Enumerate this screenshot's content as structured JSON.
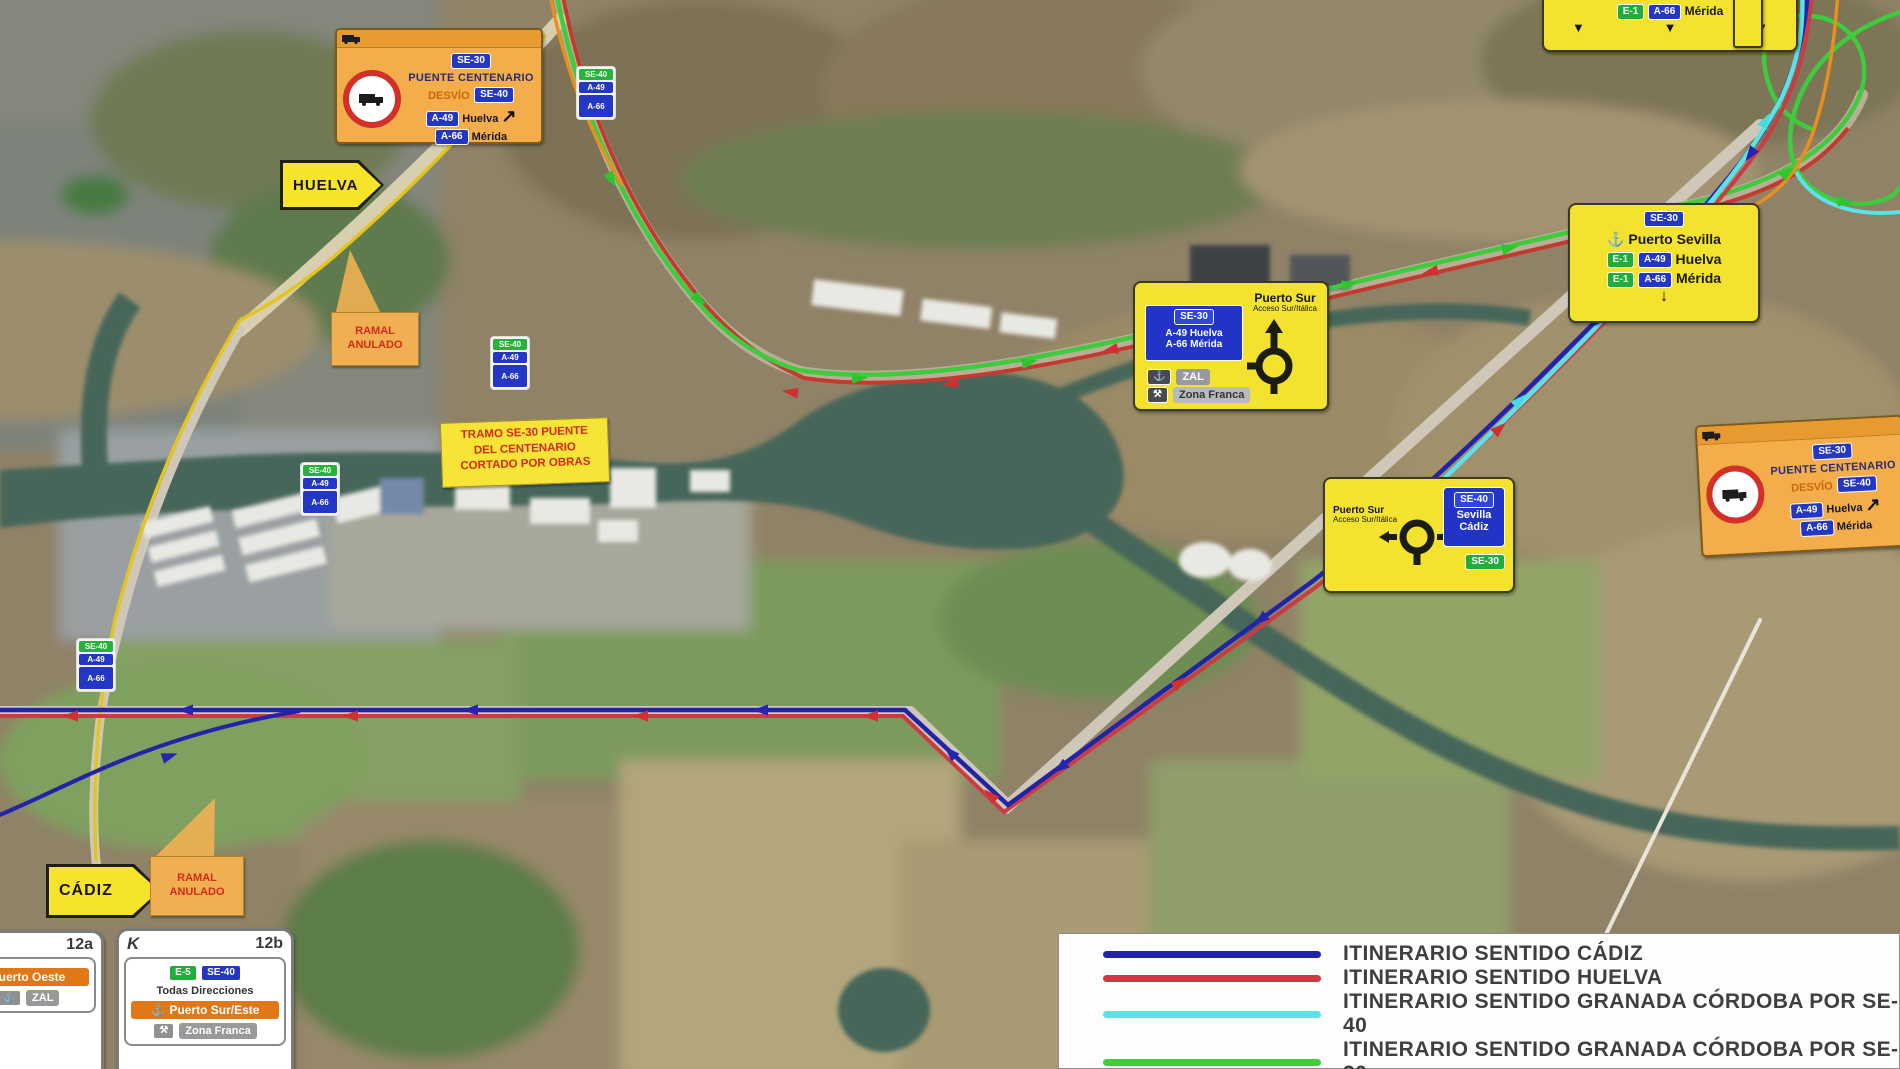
{
  "colors": {
    "route_cadiz_blue": "#2323a8",
    "route_huelva_red": "#cc3a44",
    "route_granada_se40_cyan": "#5ce2e6",
    "route_granada_se30_green": "#3ecb3e",
    "sign_yellow": "#f3e32e",
    "sign_orange": "#f3ae4b"
  },
  "shields": {
    "se30": "SE-30",
    "se40": "SE-40",
    "a49": "A-49",
    "a66": "A-66",
    "e1": "E-1",
    "e5": "E-5"
  },
  "destinations": {
    "huelva": "Huelva",
    "merida": "Mérida",
    "sevilla": "Sevilla",
    "cadiz": "Cádiz"
  },
  "signs": {
    "detour_left": {
      "title": "PUENTE CENTENARIO",
      "desvio": "DESVÍO"
    },
    "detour_right": {
      "title": "PUENTE CENTENARIO",
      "desvio": "DESVÍO"
    },
    "huelva_arrow": "HUELVA",
    "cadiz_arrow": "CÁDIZ",
    "ramal_anulado_top": "RAMAL ANULADO",
    "ramal_anulado_bottom": "RAMAL ANULADO",
    "tramo_notice": {
      "line1": "TRAMO SE-30 PUENTE",
      "line2": "DEL CENTENARIO",
      "line3": "CORTADO POR OBRAS"
    },
    "puerto_sur_north": {
      "title": "Puerto Sur",
      "subtitle": "Acceso Sur/Itálica",
      "row1": "A-49 Huelva",
      "row2": "A-66 Mérida",
      "zal": "ZAL",
      "zona": "Zona Franca"
    },
    "puerto_sur_south": {
      "title": "Puerto Sur",
      "subtitle": "Acceso Sur/Itálica"
    },
    "puerto_sevilla": {
      "title": "Puerto Sevilla"
    },
    "merida_top": {
      "dest": "Mérida"
    },
    "panel_a": {
      "exit": "12a",
      "dest": "Puerto Oeste",
      "zal": "ZAL"
    },
    "panel_b": {
      "exit": "12b",
      "glyph": "K",
      "all_directions": "Todas Direcciones",
      "dest": "Puerto Sur/Este",
      "zona": "Zona Franca"
    }
  },
  "legend": {
    "rows": [
      {
        "label": "ITINERARIO SENTIDO CÁDIZ",
        "color": "#2323a8"
      },
      {
        "label": "ITINERARIO SENTIDO HUELVA",
        "color": "#cc3a44"
      },
      {
        "label": "ITINERARIO SENTIDO GRANADA CÓRDOBA POR SE-40",
        "color": "#5ce2e6"
      },
      {
        "label": "ITINERARIO SENTIDO GRANADA CÓRDOBA POR SE-30",
        "color": "#3ecb3e"
      }
    ]
  }
}
